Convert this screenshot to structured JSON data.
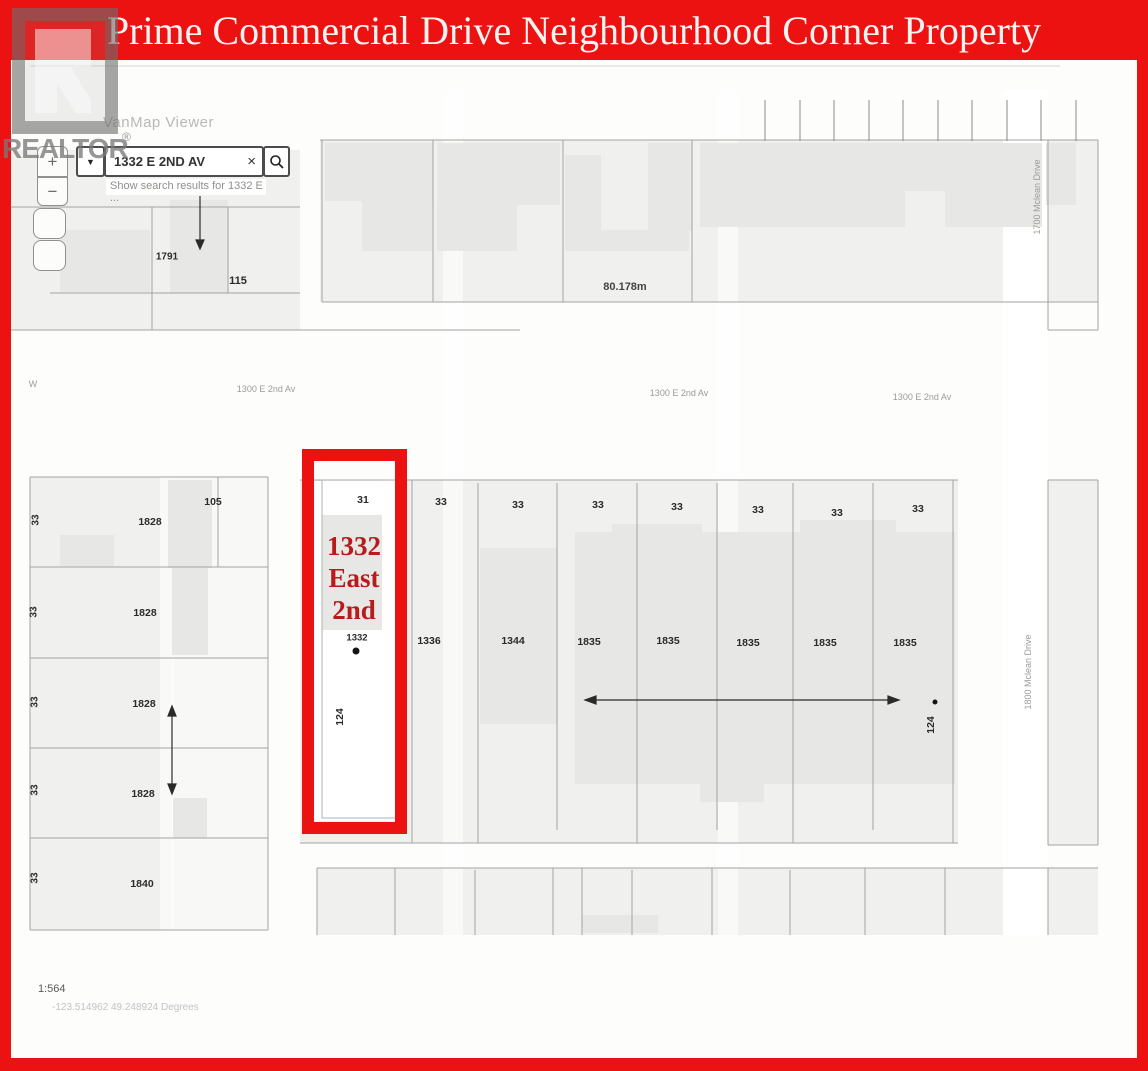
{
  "banner": {
    "title": "Prime Commercial Drive Neighbourhood Corner Property"
  },
  "watermark": {
    "brand": "REALTOR",
    "registered_mark": "®"
  },
  "toolbar": {
    "app_title": "VanMap Viewer",
    "zoom_in": "+",
    "zoom_out": "−",
    "dropdown_icon": "▼",
    "search_value": "1332 E 2ND AV",
    "clear_icon": "×",
    "search_hint": "Show search results for 1332 E ..."
  },
  "statusbar": {
    "scale": "1:564",
    "coordinates": "-123.514962 49.248924 Degrees"
  },
  "highlight": {
    "callout": "1332 East 2nd"
  },
  "streets": {
    "w_abbrev": "W",
    "e2nd": [
      "1300 E 2nd Av",
      "1300 E 2nd Av",
      "1300 E 2nd Av"
    ],
    "mclean_north": "1700 Mclean Drive",
    "mclean_south": "1800 Mclean Drive"
  },
  "measurements": {
    "block_width": "80.178m",
    "lot_depth_west": "124",
    "lot_depth_east": "124"
  },
  "lots": {
    "north_block": [
      "1791",
      "115"
    ],
    "west_widths": [
      "33",
      "33",
      "33",
      "33",
      "33"
    ],
    "west_numbers": [
      "105",
      "1828",
      "1828",
      "1828",
      "1828",
      "1840"
    ],
    "south_widths": [
      "31",
      "33",
      "33",
      "33",
      "33",
      "33",
      "33",
      "33"
    ],
    "south_numbers": [
      "1332",
      "1336",
      "1344",
      "1835",
      "1835",
      "1835",
      "1835",
      "1835"
    ]
  },
  "colors": {
    "frame_red": "#ec1212",
    "callout_red": "#b71b1b"
  }
}
